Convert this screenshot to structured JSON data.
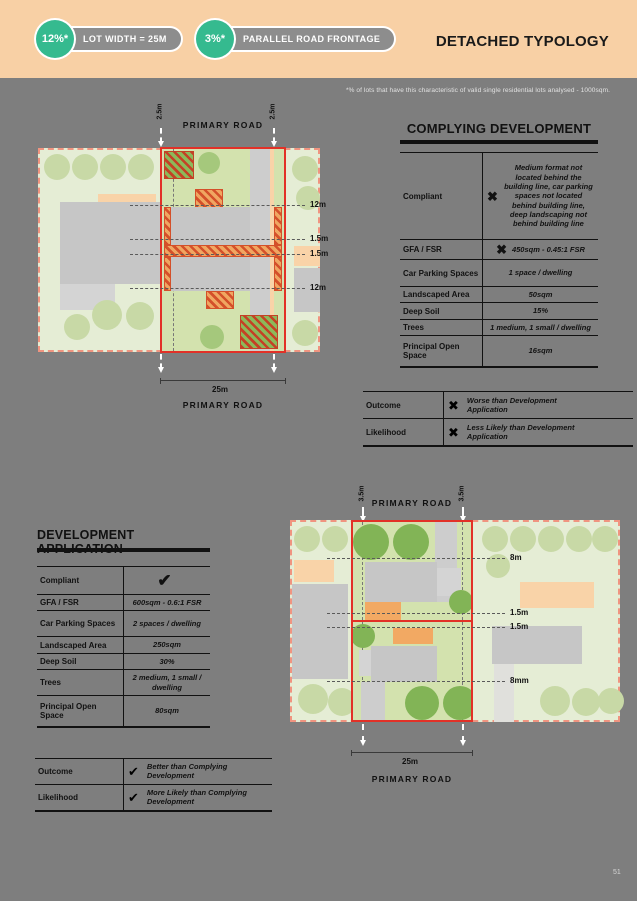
{
  "header": {
    "stat1": {
      "value": "12%*",
      "label": "LOT WIDTH = 25M"
    },
    "stat2": {
      "value": "3%*",
      "label": "PARALLEL ROAD FRONTAGE"
    },
    "title": "DETACHED TYPOLOGY"
  },
  "footnote": "*% of lots that have this characteristic of valid single residential lots analysed - 1000sqm.",
  "page_number": "51",
  "colors": {
    "header_bg": "#F8D0A5",
    "badge_green": "#35BA8F",
    "page_bg": "#7E7E7E",
    "lot_outline_red": "#E23127",
    "site_border_pink": "#F09480"
  },
  "complying_development": {
    "title": "COMPLYING DEVELOPMENT",
    "rows": [
      {
        "label": "Compliant",
        "icon": "cross",
        "value": "Medium format not located behind the building line, car parking spaces not located behind building line, deep landscaping not behind building line"
      },
      {
        "label": "GFA / FSR",
        "icon": "cross",
        "value": "450sqm - 0.45:1 FSR"
      },
      {
        "label": "Car Parking Spaces",
        "icon": "",
        "value": "1 space / dwelling"
      },
      {
        "label": "Landscaped Area",
        "icon": "",
        "value": "50sqm"
      },
      {
        "label": "Deep Soil",
        "icon": "",
        "value": "15%"
      },
      {
        "label": "Trees",
        "icon": "",
        "value": "1 medium, 1 small / dwelling"
      },
      {
        "label": "Principal Open Space",
        "icon": "",
        "value": "16sqm"
      }
    ],
    "outcome_rows": [
      {
        "label": "Outcome",
        "icon": "cross",
        "text": "Worse than Development Application"
      },
      {
        "label": "Likelihood",
        "icon": "cross",
        "text": "Less Likely than Development Application"
      }
    ]
  },
  "development_application": {
    "title": "DEVELOPMENT APPLICATION",
    "rows": [
      {
        "label": "Compliant",
        "icon": "check",
        "value": ""
      },
      {
        "label": "GFA / FSR",
        "icon": "",
        "value": "600sqm - 0.6:1 FSR"
      },
      {
        "label": "Car Parking Spaces",
        "icon": "",
        "value": "2 spaces / dwelling"
      },
      {
        "label": "Landscaped Area",
        "icon": "",
        "value": "250sqm"
      },
      {
        "label": "Deep Soil",
        "icon": "",
        "value": "30%"
      },
      {
        "label": "Trees",
        "icon": "",
        "value": "2 medium, 1 small / dwelling"
      },
      {
        "label": "Principal Open Space",
        "icon": "",
        "value": "80sqm"
      }
    ],
    "outcome_rows": [
      {
        "label": "Outcome",
        "icon": "check",
        "text": "Better than Complying Development"
      },
      {
        "label": "Likelihood",
        "icon": "check",
        "text": "More Likely than Complying Development"
      }
    ]
  },
  "diagram_top": {
    "road_top": "PRIMARY ROAD",
    "road_bottom": "PRIMARY ROAD",
    "setback_left": "2.5m",
    "setback_right": "2.5m",
    "dim_labels": [
      "12m",
      "1.5m",
      "1.5m",
      "12m"
    ],
    "lot_width": "25m"
  },
  "diagram_bottom": {
    "road_top": "PRIMARY ROAD",
    "road_bottom": "PRIMARY ROAD",
    "setback_left": "3.5m",
    "setback_right": "3.5m",
    "dim_labels": [
      "8m",
      "1.5m",
      "1.5m",
      "8mm"
    ],
    "lot_width": "25m"
  }
}
